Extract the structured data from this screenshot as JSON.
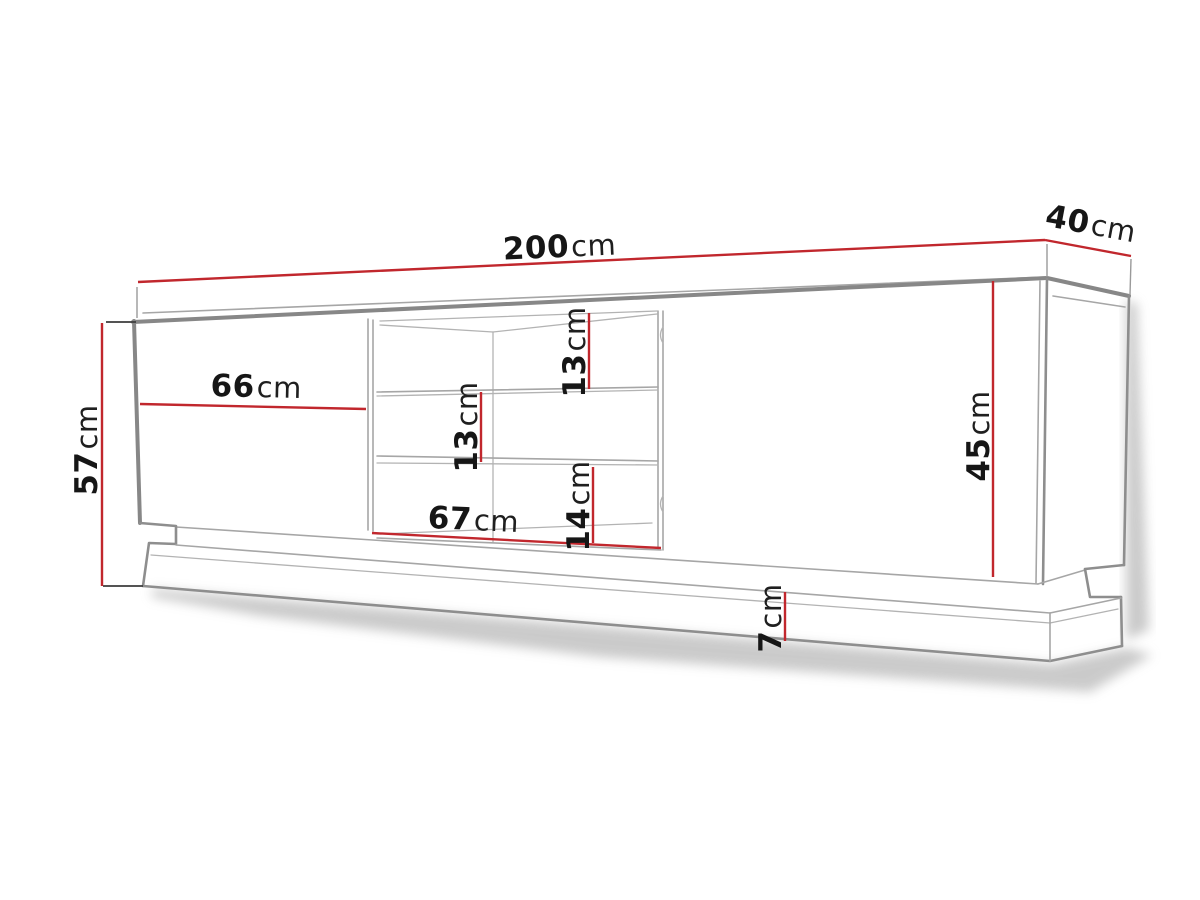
{
  "title": "TV stand technical dimension drawing",
  "colors": {
    "dimension_line": "#c1272d",
    "outline_gray": "#878787",
    "inner_line_gray": "#a6a6a6",
    "text": "#161616",
    "background": "#ffffff",
    "shadow": "#a0a0a0"
  },
  "dimensions": {
    "total_width": {
      "value": "200",
      "unit": "cm"
    },
    "depth": {
      "value": "40",
      "unit": "cm"
    },
    "total_height": {
      "value": "57",
      "unit": "cm"
    },
    "left_door_width": {
      "value": "66",
      "unit": "cm"
    },
    "niche_width": {
      "value": "67",
      "unit": "cm"
    },
    "niche_top_height": {
      "value": "13",
      "unit": "cm"
    },
    "niche_middle_height": {
      "value": "13",
      "unit": "cm"
    },
    "niche_bottom_height": {
      "value": "14",
      "unit": "cm"
    },
    "front_height": {
      "value": "45",
      "unit": "cm"
    },
    "plinth_height": {
      "value": "7",
      "unit": "cm"
    }
  }
}
